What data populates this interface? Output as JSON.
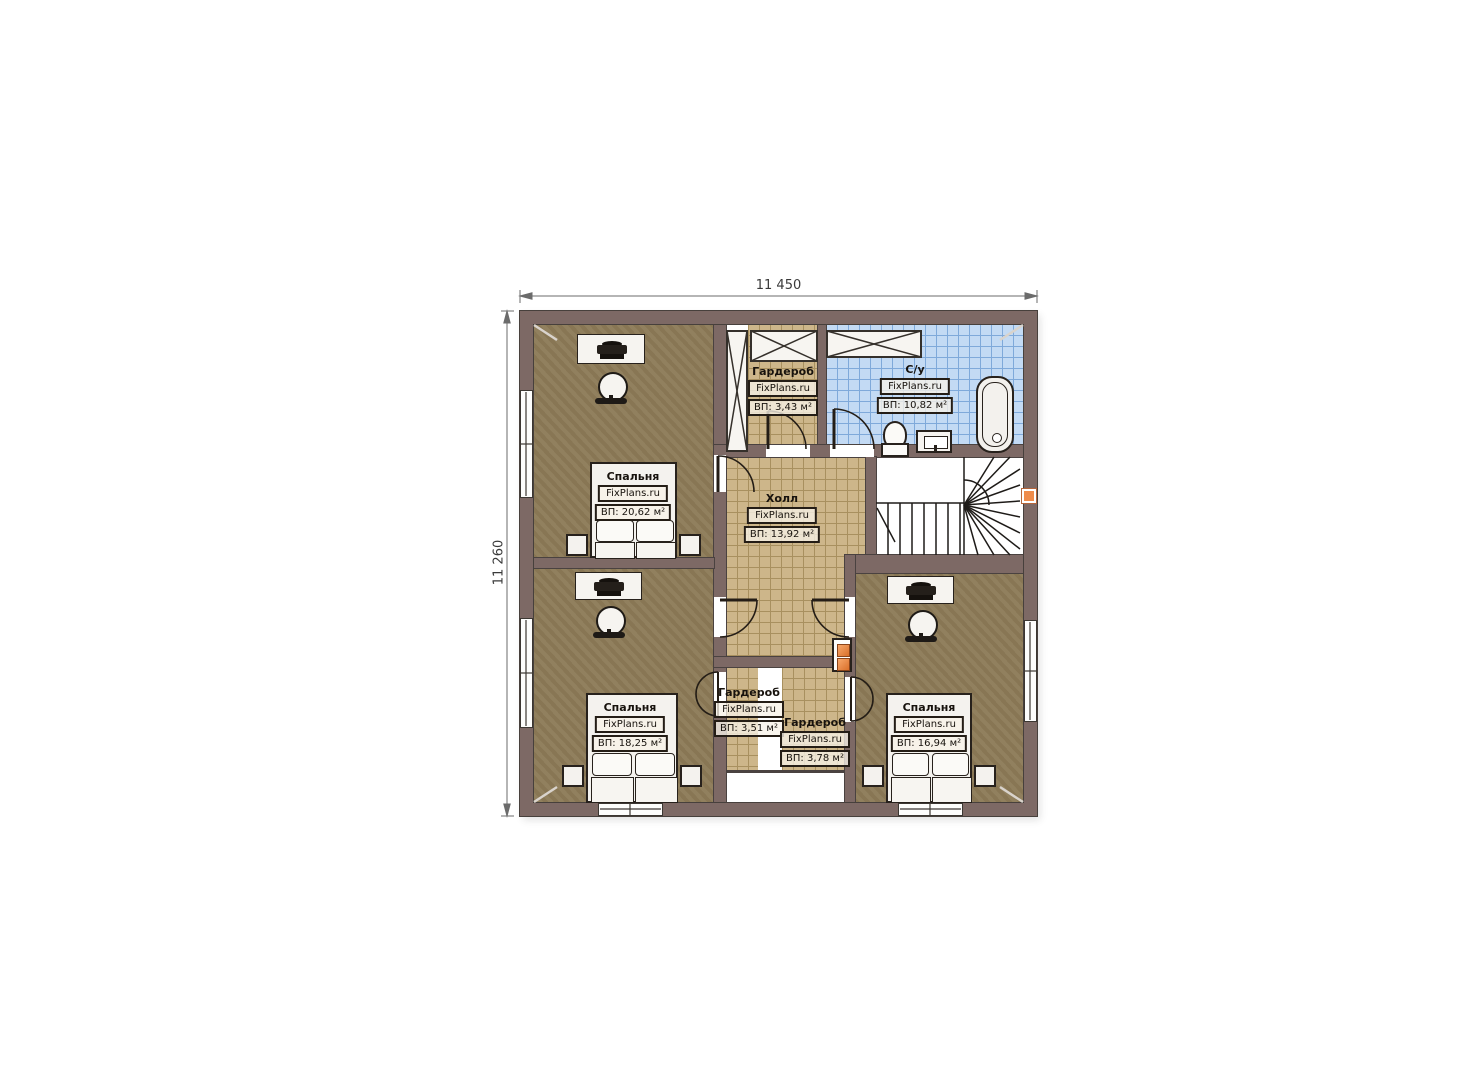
{
  "plan": {
    "brand": "FixPlans.ru",
    "dimensions": {
      "width_label": "11 450",
      "height_label": "11 260"
    },
    "rooms": {
      "bedroom_top_left": {
        "name": "Спальня",
        "brand": "FixPlans.ru",
        "area": "ВП: 20,62 м²"
      },
      "wardrobe_top": {
        "name": "Гардероб",
        "brand": "FixPlans.ru",
        "area": "ВП: 3,43 м²"
      },
      "bathroom": {
        "name": "С/у",
        "brand": "FixPlans.ru",
        "area": "ВП: 10,82 м²"
      },
      "hall": {
        "name": "Холл",
        "brand": "FixPlans.ru",
        "area": "ВП: 13,92 м²"
      },
      "bedroom_bottom_left": {
        "name": "Спальня",
        "brand": "FixPlans.ru",
        "area": "ВП: 18,25 м²"
      },
      "wardrobe_bottom_left": {
        "name": "Гардероб",
        "brand": "FixPlans.ru",
        "area": "ВП: 3,51 м²"
      },
      "wardrobe_bottom_right": {
        "name": "Гардероб",
        "brand": "FixPlans.ru",
        "area": "ВП: 3,78 м²"
      },
      "bedroom_bottom_right": {
        "name": "Спальня",
        "brand": "FixPlans.ru",
        "area": "ВП: 16,94 м²"
      }
    },
    "colors": {
      "wall": "#7d6965",
      "wall_outline": "#4a4240",
      "bedroom_floor": "#8d7b58",
      "hall_floor": "#cdb68a",
      "bathroom_floor": "#c3daf4",
      "furniture_outline": "#241d16",
      "accent_orange": "#ef8b4a"
    }
  }
}
